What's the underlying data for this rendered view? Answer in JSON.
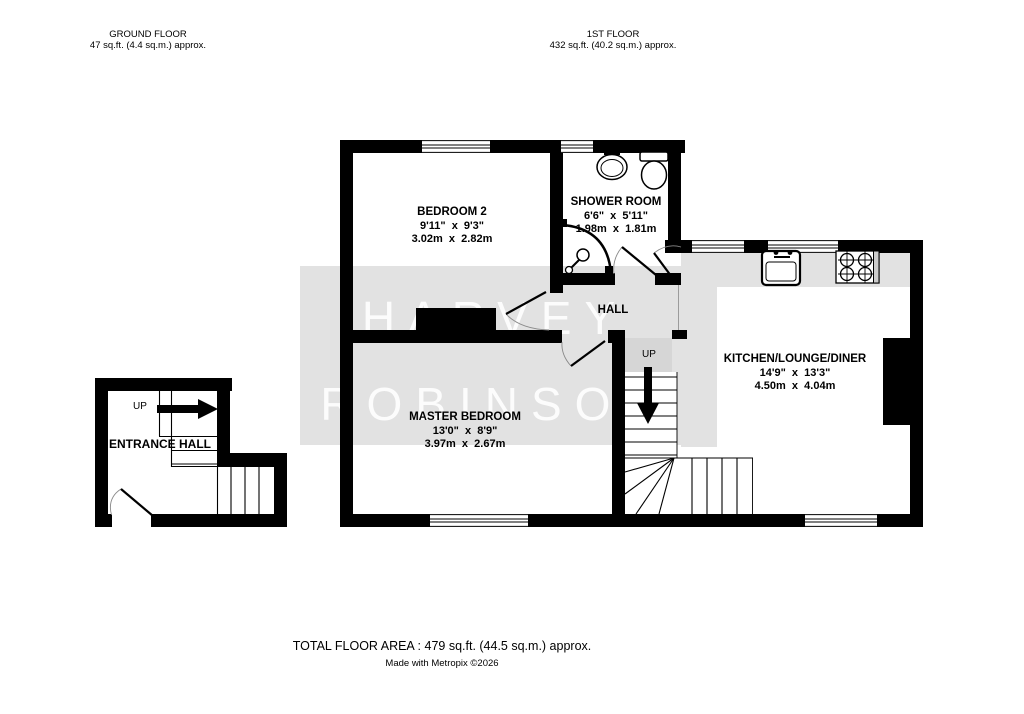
{
  "headers": {
    "ground_floor": {
      "title": "GROUND FLOOR",
      "area": "47 sq.ft. (4.4 sq.m.) approx."
    },
    "first_floor": {
      "title": "1ST FLOOR",
      "area": "432 sq.ft. (40.2 sq.m.) approx."
    }
  },
  "rooms": {
    "bedroom2": {
      "name": "BEDROOM 2",
      "imperial": "9'11\"  x  9'3\"",
      "metric": "3.02m  x  2.82m"
    },
    "shower_room": {
      "name": "SHOWER ROOM",
      "imperial": "6'6\"  x  5'11\"",
      "metric": "1.98m  x  1.81m"
    },
    "hall": {
      "name": "HALL"
    },
    "master_bedroom": {
      "name": "MASTER BEDROOM",
      "imperial": "13'0\"  x  8'9\"",
      "metric": "3.97m  x  2.67m"
    },
    "kitchen": {
      "name": "KITCHEN/LOUNGE/DINER",
      "imperial": "14'9\"  x  13'3\"",
      "metric": "4.50m  x  4.04m"
    },
    "entrance_hall": {
      "name": "ENTRANCE HALL"
    }
  },
  "stairs": {
    "ground_up_label": "UP",
    "first_up_label": "UP"
  },
  "watermark": {
    "line1": "HARVEY",
    "line2": "ROBINSON"
  },
  "footer": {
    "total_area": "TOTAL FLOOR AREA : 479 sq.ft. (44.5 sq.m.) approx.",
    "credit": "Made with Metropix ©2026"
  },
  "colors": {
    "wall": "#000000",
    "watermark_box": "#e2e2e2",
    "worktop": "#e2e2e2",
    "stair_landing": "#d6d6d6",
    "door_arc": "#8a8a8a"
  }
}
